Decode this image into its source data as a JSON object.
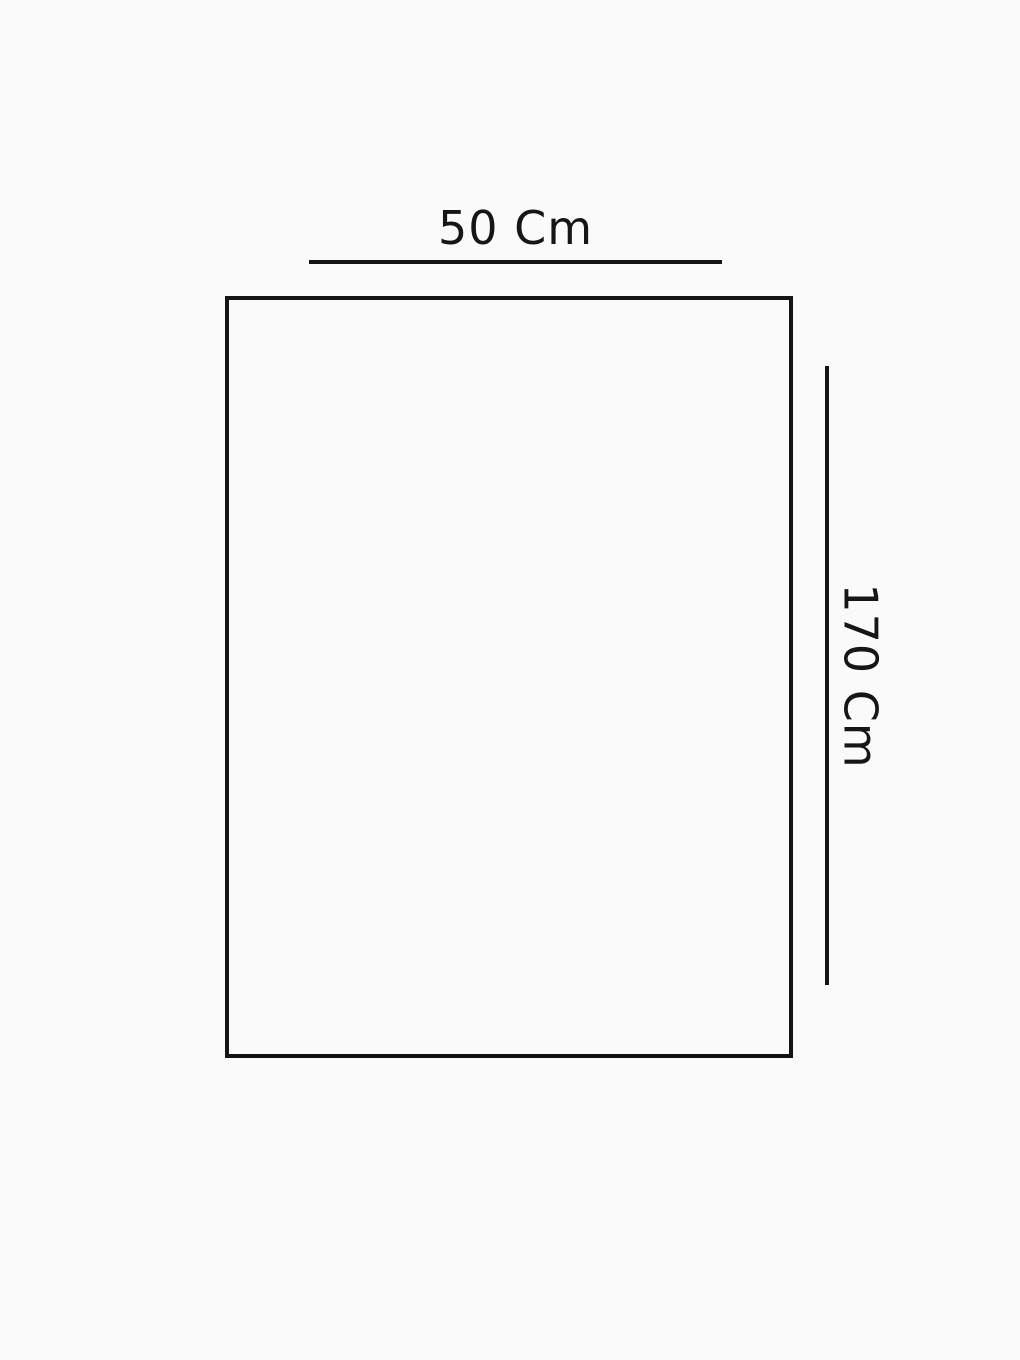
{
  "diagram": {
    "type": "dimension-diagram",
    "shape": "rectangle",
    "width_label": "50 Cm",
    "height_label": "170 Cm",
    "width_value_cm": 50,
    "height_value_cm": 170,
    "unit": "Cm",
    "colors": {
      "line": "#141414",
      "text": "#161616",
      "background": "#fbfafa"
    }
  }
}
